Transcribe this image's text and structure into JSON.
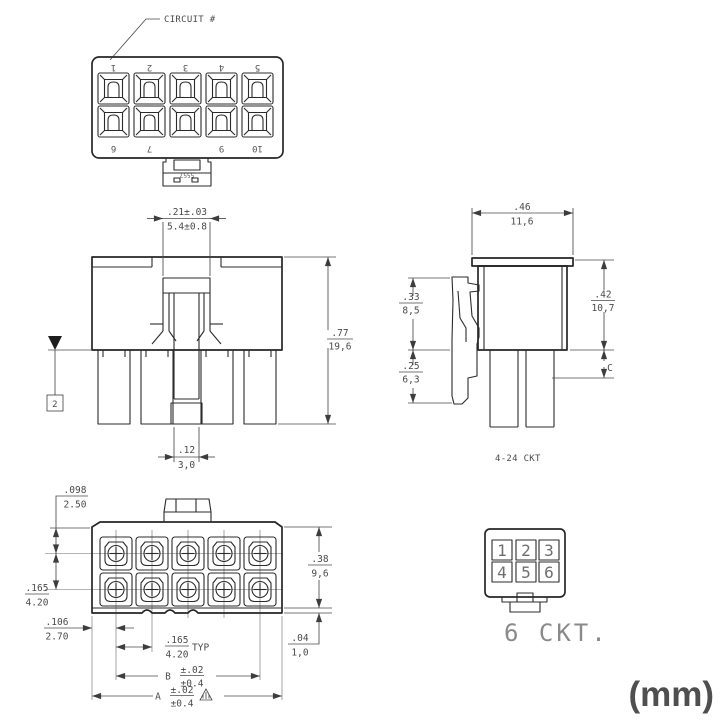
{
  "sheet": {
    "units_label": "(mm)"
  },
  "top_view": {
    "callout": "CIRCUIT #",
    "part_number": "5557",
    "row1": [
      "1",
      "2",
      "3",
      "4",
      "5"
    ],
    "row2": [
      "6",
      "7",
      "9",
      "10"
    ]
  },
  "front_view": {
    "flag_note": "2",
    "dim_latch_width": {
      "in": ".21±.03",
      "mm": "5.4±0.8"
    },
    "dim_height": {
      "in": ".77",
      "mm": "19,6"
    },
    "dim_beam": {
      "in": ".12",
      "mm": "3,0"
    }
  },
  "side_view": {
    "dim_width": {
      "in": ".46",
      "mm": "11,6"
    },
    "dim_body_height": {
      "in": ".42",
      "mm": "10,7"
    },
    "dim_latch_upper": {
      "in": ".33",
      "mm": "8,5"
    },
    "dim_latch_lower": {
      "in": ".25",
      "mm": "6,3"
    },
    "ref_c": "C",
    "range_note": "4-24 CKT"
  },
  "face_view": {
    "dim_edge_row": {
      "in": ".098",
      "mm": "2.50"
    },
    "dim_row_pitch": {
      "in": ".165",
      "mm": "4.20"
    },
    "dim_edge_col": {
      "in": ".106",
      "mm": "2.70"
    },
    "dim_col_pitch": {
      "in": ".165",
      "mm": "4.20",
      "suffix": "TYP"
    },
    "dim_height": {
      "in": ".38",
      "mm": "9,6"
    },
    "dim_lip": {
      "in": ".04",
      "mm": "1,0"
    },
    "dim_b": {
      "label": "B",
      "in": "±.02",
      "mm": "±0.4"
    },
    "dim_a": {
      "label": "A",
      "in": "±.02",
      "mm": "±0.4"
    }
  },
  "six_ckt": {
    "numbers": [
      "1",
      "2",
      "3",
      "4",
      "5",
      "6"
    ],
    "caption": "6 CKT."
  }
}
